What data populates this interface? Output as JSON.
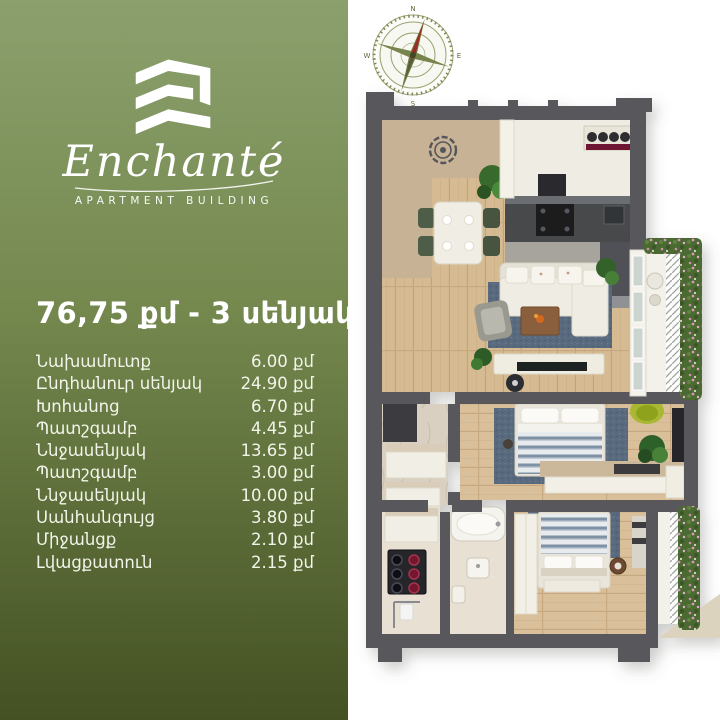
{
  "brand": {
    "name": "Enchanté",
    "tagline": "APARTMENT BUILDING",
    "logo_icon": "building-e-chevrons"
  },
  "listing": {
    "title": "76,75 քմ - 3 սենյակ",
    "rooms": [
      {
        "label": "Նախամուտք",
        "area": "6.00 քմ"
      },
      {
        "label": "Ընդհանուր սենյակ",
        "area": "24.90 քմ"
      },
      {
        "label": "Խոհանոց",
        "area": "6.70 քմ"
      },
      {
        "label": "Պատշգամբ",
        "area": "4.45 քմ"
      },
      {
        "label": "Ննջասենյակ",
        "area": "13.65 քմ"
      },
      {
        "label": "Պատշգամբ",
        "area": "3.00 քմ"
      },
      {
        "label": "Ննջասենյակ",
        "area": "10.00 քմ"
      },
      {
        "label": "Սանհանգույց",
        "area": "3.80 քմ"
      },
      {
        "label": "Միջանցք",
        "area": "2.10 քմ"
      },
      {
        "label": "Լվացքատուն",
        "area": "2.15 քմ"
      }
    ]
  },
  "compass": {
    "north": "N",
    "east": "E",
    "south": "S",
    "west": "W"
  },
  "colors": {
    "panelTop": "#8ba06d",
    "panelBottom": "#445123",
    "wall": "#58585c",
    "wood": "#d6bb92",
    "rug": "#5a6a7e",
    "hedge": "#4c6a33",
    "counter": "#47484c",
    "accentRed": "#6e1430",
    "limeChair": "#a8b832",
    "entryTan": "#c7b295"
  }
}
